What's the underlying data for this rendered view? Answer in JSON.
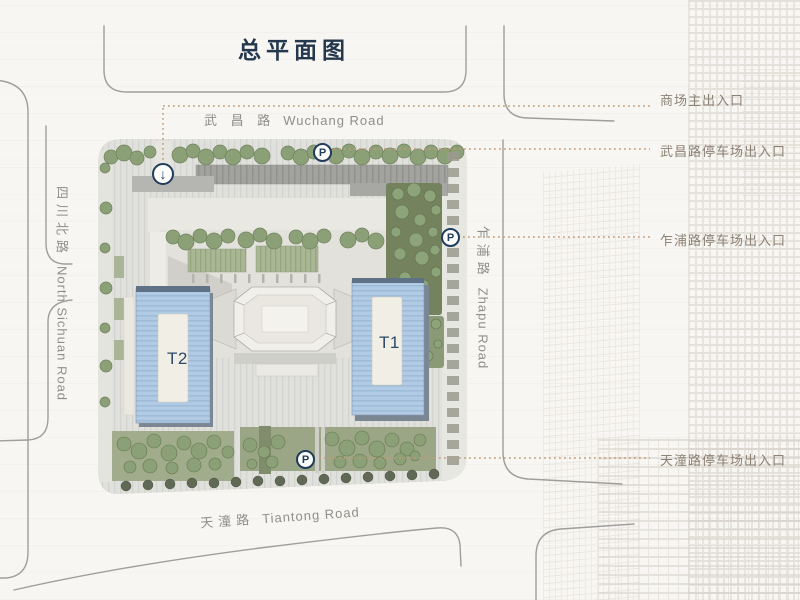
{
  "title": "总平面图",
  "roads": {
    "wuchang": {
      "zh": "武 昌 路",
      "en": "Wuchang Road"
    },
    "north_sichuan": {
      "zh": "四川北路",
      "en": "North Sichuan Road"
    },
    "zhapu": {
      "zh": "乍浦路",
      "en": "Zhapu Road"
    },
    "tiantong": {
      "zh": "天潼路",
      "en": "Tiantong Road"
    }
  },
  "annotations": [
    {
      "label": "商场主出入口"
    },
    {
      "label": "武昌路停车场出入口"
    },
    {
      "label": "乍浦路停车场出入口"
    },
    {
      "label": "天潼路停车场出入口"
    }
  ],
  "towers": {
    "t1": "T1",
    "t2": "T2"
  },
  "markers": {
    "parking": "P",
    "entrance_arrow": "↓"
  },
  "colors": {
    "title_navy": "#24384e",
    "marker_navy": "#1f3c5a",
    "annotation_gray": "#8c8175",
    "dotted_line_tan": "#c49b74",
    "road_line_gray": "#9e9e9a",
    "tower_blue": "#b2cbe4",
    "green_dark": "#74825e",
    "green_light": "#9aa685",
    "paper": "#f8f6f2"
  }
}
